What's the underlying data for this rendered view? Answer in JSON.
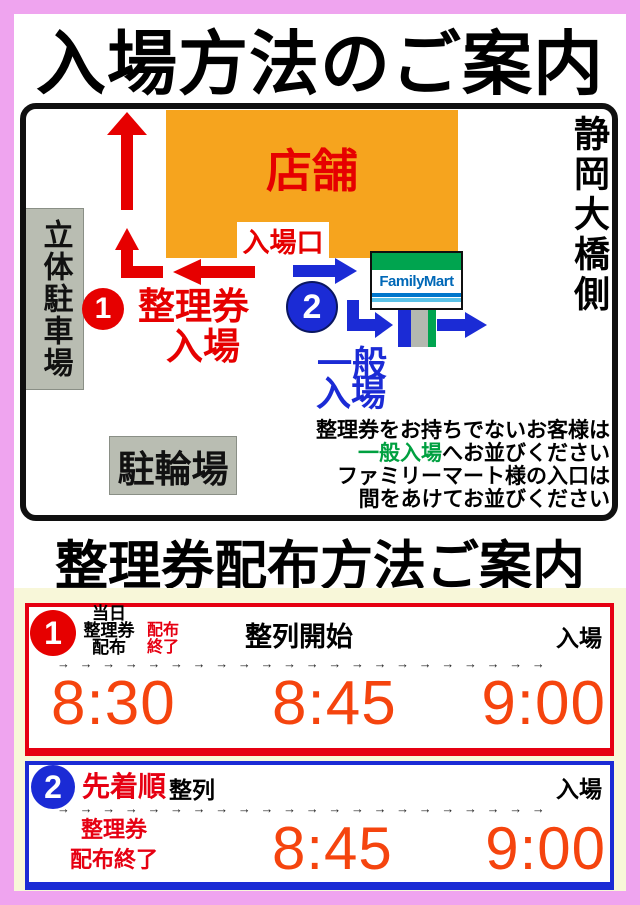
{
  "title_top": "入場方法のご案内",
  "title_schedule": "整理券配布方法ご案内",
  "map": {
    "store": "店舗",
    "entrance_gate": "入場口",
    "parking_tower": "立体駐車場",
    "bicycle_parking": "駐輪場",
    "bridge_side": "静岡大橋側",
    "familymart": "FamilyMart",
    "route1": {
      "number": "1",
      "line1": "整理券",
      "line2": "入場"
    },
    "route2": {
      "number": "2",
      "line1": "一般",
      "line2": "入場"
    },
    "notice": {
      "line1": "整理券をお持ちでないお客様は",
      "line2_green": "一般入場",
      "line2_rest": "へお並びください",
      "line3": "ファミリーマート様の入口は",
      "line4": "間をあけてお並びください"
    }
  },
  "schedule": {
    "box1": {
      "number": "1",
      "left_lines": [
        "当日",
        "整理券",
        "配布"
      ],
      "sub_red_lines": [
        "配布",
        "終了"
      ],
      "mid_label": "整列開始",
      "right_label": "入場",
      "arrows": "→ → → → → → → → → → → → → → → → → → → → → →",
      "times": [
        "8:30",
        "8:45",
        "9:00"
      ]
    },
    "box2": {
      "number": "2",
      "label_red": "先着順",
      "label_black": "整列",
      "right_label": "入場",
      "arrows": "→ → → → → → → → → → → → → → → → → → → → → →",
      "left_red_lines": [
        "整理券",
        "配布終了"
      ],
      "times": [
        "8:45",
        "9:00"
      ]
    }
  },
  "colors": {
    "frame_pink": "#efa4ef",
    "cream_background": "#f8f7d9",
    "store_orange": "#f6a41e",
    "signal_red": "#e60012",
    "time_orange_red": "#f5440e",
    "route_blue": "#1b2bd5",
    "notice_green": "#00a040",
    "familymart_green": "#00a44f",
    "familymart_blue": "#0068b7",
    "familymart_lightblue": "#5bc2e7",
    "gray_box": "#b9bdb2"
  }
}
